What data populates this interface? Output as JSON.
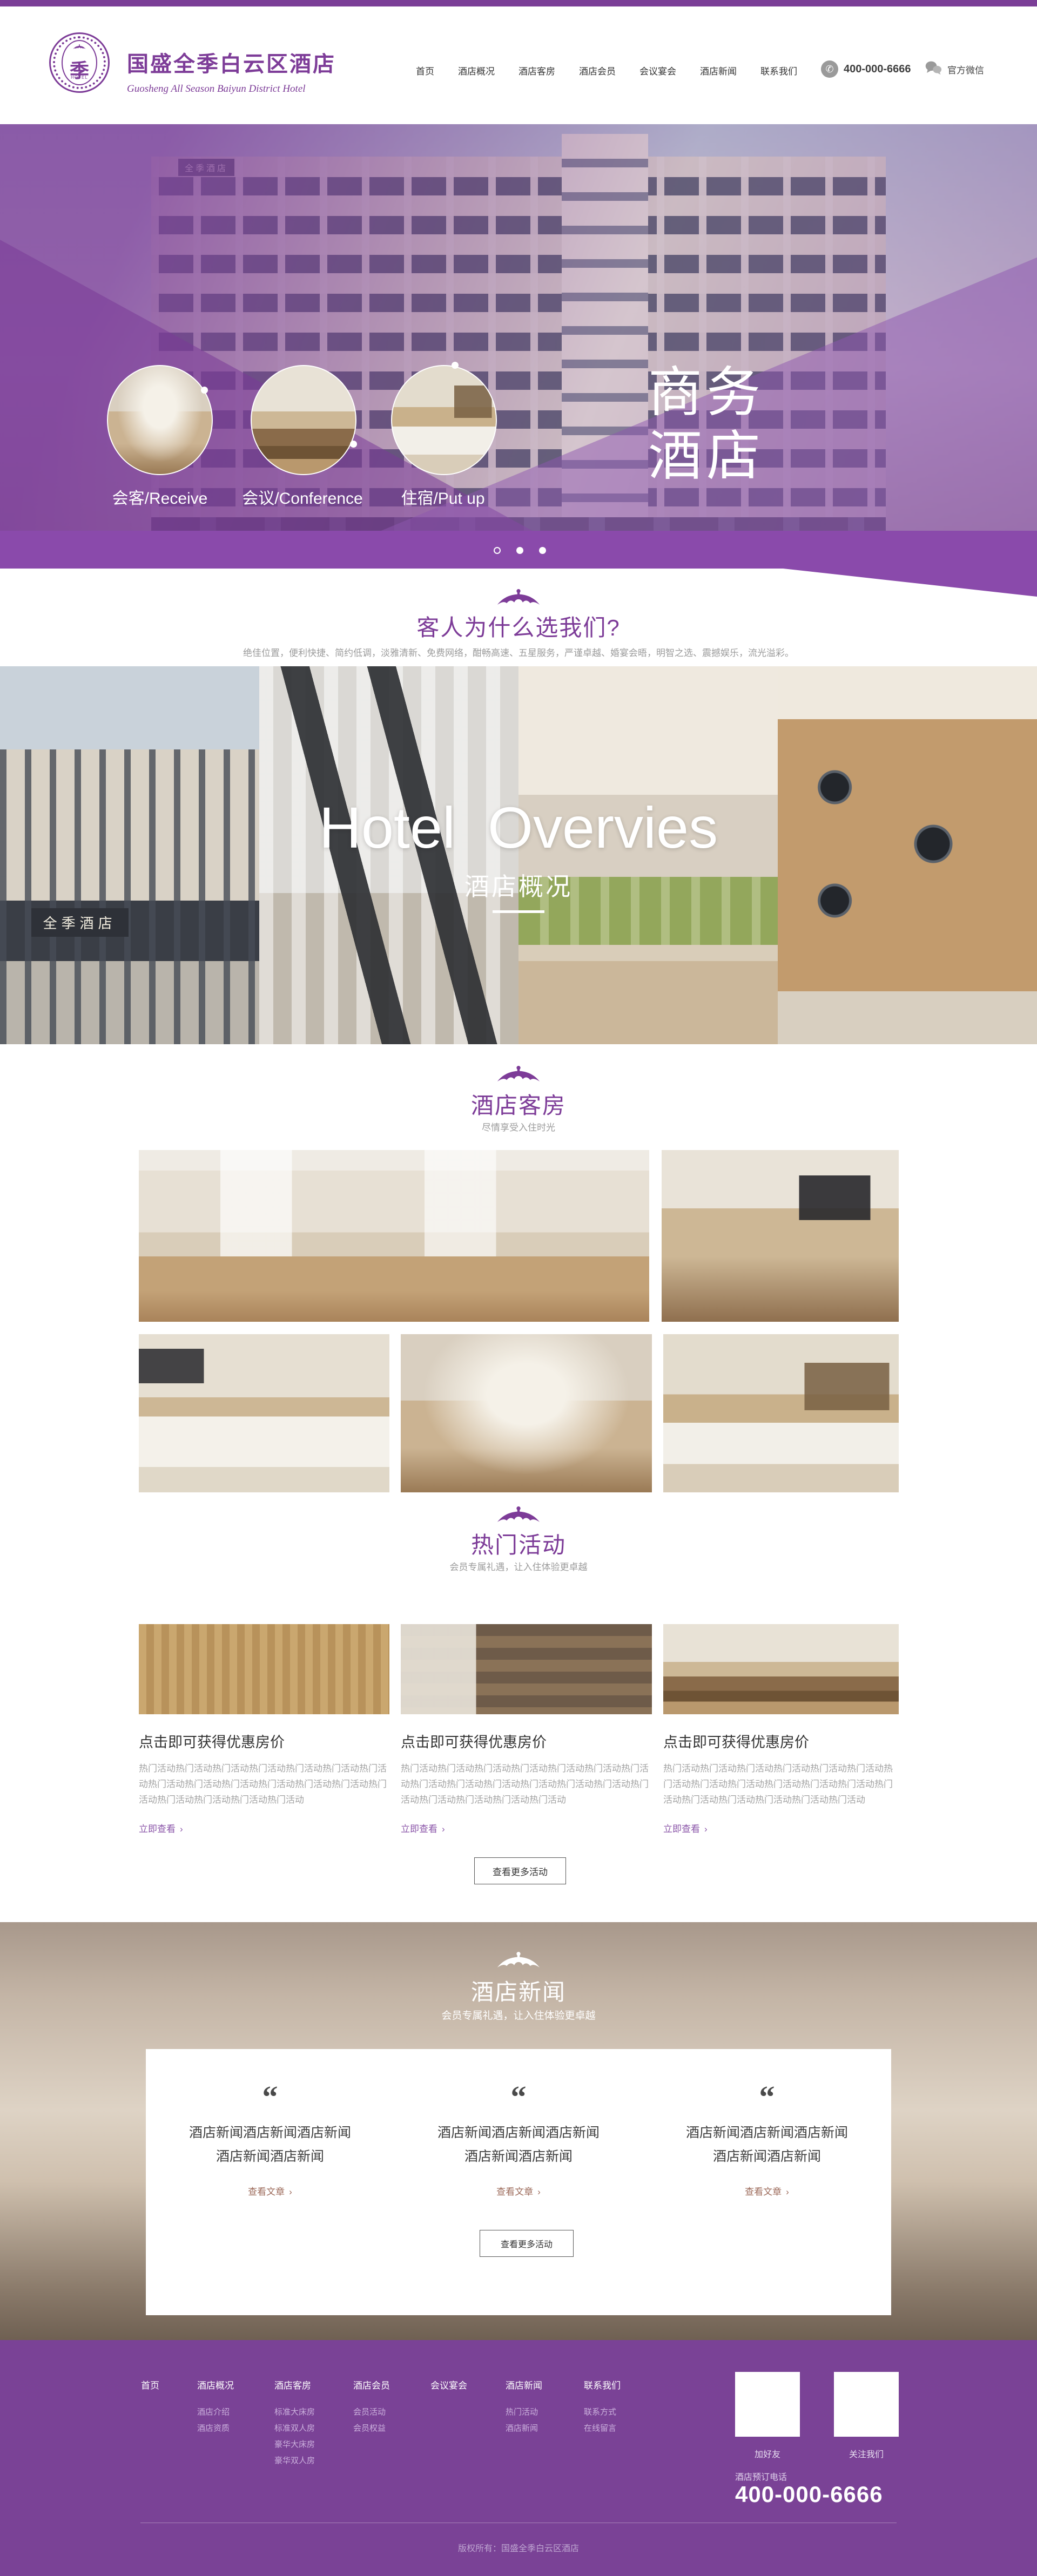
{
  "colors": {
    "brand_purple": "#7d3c98",
    "topbar_purple": "#7b3e97",
    "hero_purple": "#8a4aab",
    "footer_purple": "#7a4296",
    "link_purple": "#8a55a8",
    "news_link_brown": "#9c6a5a"
  },
  "shared": {
    "chevron": "›"
  },
  "brand": {
    "logo_char": "季",
    "logo_sub": "HOTEL",
    "title": "国盛全季白云区酒店",
    "subtitle": "Guosheng All Season Baiyun District Hotel"
  },
  "nav": {
    "items": [
      "首页",
      "酒店概况",
      "酒店客房",
      "酒店会员",
      "会议宴会",
      "酒店新闻",
      "联系我们"
    ],
    "phone": "400-000-6666",
    "wechat": "官方微信"
  },
  "hero": {
    "building_sign": "全季酒店",
    "features": [
      {
        "label": "会客/Receive"
      },
      {
        "label": "会议/Conference"
      },
      {
        "label": "住宿/Put up"
      }
    ],
    "headline_line1": "商务",
    "headline_line2": "酒店"
  },
  "why_us": {
    "title": "客人为什么选我们?",
    "subtitle": "绝佳位置，便利快捷、简约低调，淡雅清新、免费网络，酣畅高速、五星服务，严谨卓越、婚宴会晤，明智之选、震撼娱乐，流光溢彩。"
  },
  "overview": {
    "headline": "Hotel  Overvies",
    "subtitle": "酒店概况",
    "storefront_sign": "全季酒店"
  },
  "rooms": {
    "title": "酒店客房",
    "subtitle": "尽情享受入住时光"
  },
  "activities": {
    "title": "热门活动",
    "subtitle": "会员专属礼遇，让入住体验更卓越",
    "cards": [
      {
        "title": "点击即可获得优惠房价",
        "desc": "热门活动热门活动热门活动热门活动热门活动热门活动热门活动热门活动热门活动热门活动热门活动热门活动热门活动热门活动热门活动热门活动热门活动热门活动",
        "link_label": "立即查看"
      },
      {
        "title": "点击即可获得优惠房价",
        "desc": "热门活动热门活动热门活动热门活动热门活动热门活动热门活动热门活动热门活动热门活动热门活动热门活动热门活动热门活动热门活动热门活动热门活动热门活动",
        "link_label": "立即查看"
      },
      {
        "title": "点击即可获得优惠房价",
        "desc": "热门活动热门活动热门活动热门活动热门活动热门活动热门活动热门活动热门活动热门活动热门活动热门活动热门活动热门活动热门活动热门活动热门活动热门活动",
        "link_label": "立即查看"
      }
    ],
    "more_label": "查看更多活动"
  },
  "news": {
    "title": "酒店新闻",
    "subtitle": "会员专属礼遇，让入住体验更卓越",
    "quote_mark": "“",
    "items": [
      {
        "text": "酒店新闻酒店新闻酒店新闻酒店新闻酒店新闻",
        "link_label": "查看文章"
      },
      {
        "text": "酒店新闻酒店新闻酒店新闻酒店新闻酒店新闻",
        "link_label": "查看文章"
      },
      {
        "text": "酒店新闻酒店新闻酒店新闻酒店新闻酒店新闻",
        "link_label": "查看文章"
      }
    ],
    "more_label": "查看更多活动"
  },
  "footer": {
    "columns": [
      {
        "title": "首页",
        "items": []
      },
      {
        "title": "酒店概况",
        "items": [
          "酒店介绍",
          "酒店资质"
        ]
      },
      {
        "title": "酒店客房",
        "items": [
          "标准大床房",
          "标准双人房",
          "豪华大床房",
          "豪华双人房"
        ]
      },
      {
        "title": "酒店会员",
        "items": [
          "会员活动",
          "会员权益"
        ]
      },
      {
        "title": "会议宴会",
        "items": []
      },
      {
        "title": "酒店新闻",
        "items": [
          "热门活动",
          "酒店新闻"
        ]
      },
      {
        "title": "联系我们",
        "items": [
          "联系方式",
          "在线留言"
        ]
      }
    ],
    "qr_labels": [
      "加好友",
      "关注我们"
    ],
    "hotline_label": "酒店预订电话",
    "hotline": "400-000-6666",
    "copyright": "版权所有：国盛全季白云区酒店"
  }
}
